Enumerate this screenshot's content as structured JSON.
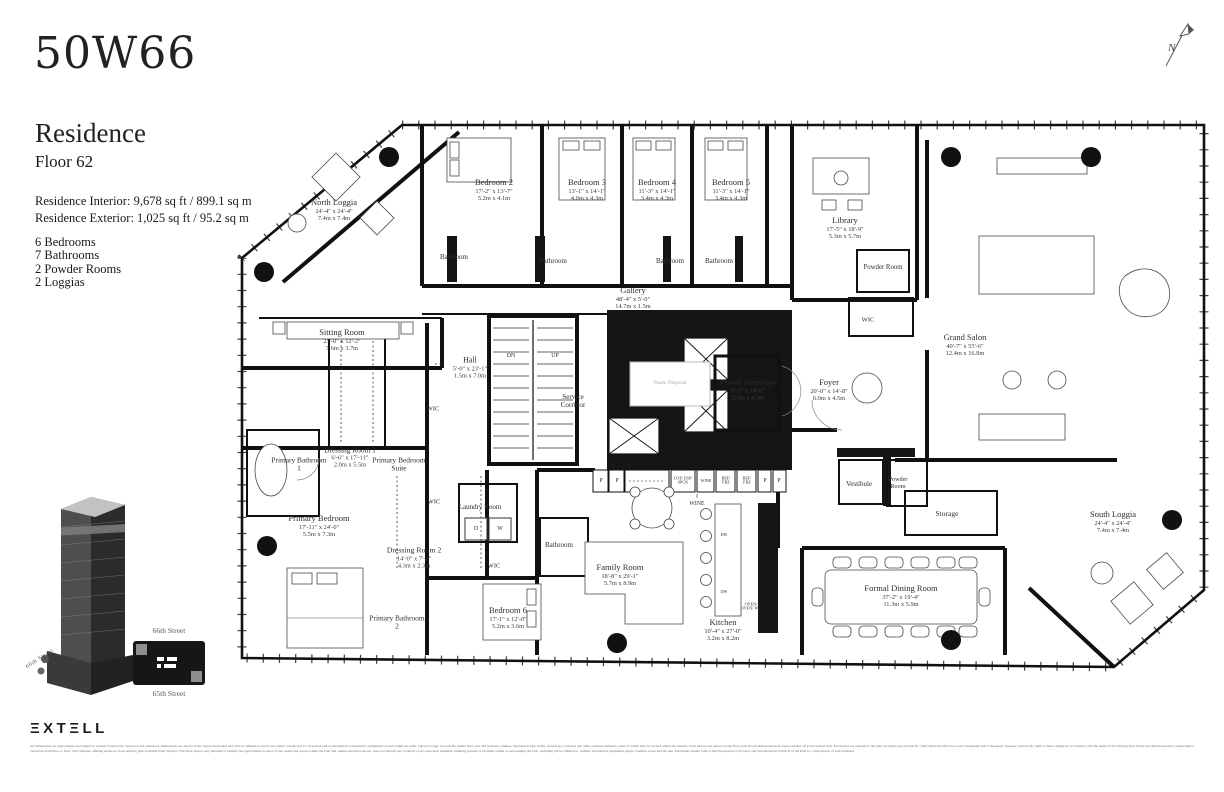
{
  "brand": {
    "logo": "50W66",
    "extell": "EXTELL",
    "extell_display": "ΞXTΞLL"
  },
  "header": {
    "title": "Residence",
    "floor": "Floor 62",
    "interior": "Residence Interior: 9,678 sq ft / 899.1 sq m",
    "exterior": "Residence Exterior: 1,025 sq ft / 95.2 sq m",
    "features": [
      "6 Bedrooms",
      "7 Bathrooms",
      "2 Powder Rooms",
      "2 Loggias"
    ]
  },
  "compass": {
    "label": "N"
  },
  "site": {
    "street_top": "66th Street",
    "street_bottom": "65th Street",
    "tower_street": "66th Street"
  },
  "plan": {
    "rooms": [
      {
        "n": "North Loggia",
        "f": "24'-4\" x 24'-4\"",
        "m": "7.4m x 7.4m",
        "x": 97,
        "y": 92
      },
      {
        "n": "Bedroom 2",
        "f": "17'-2\" x 13'-7\"",
        "m": "5.2m x 4.1m",
        "x": 257,
        "y": 72
      },
      {
        "n": "Bedroom 3",
        "f": "13'-1\" x 14'-1\"",
        "m": "4.0m x 4.3m",
        "x": 350,
        "y": 72
      },
      {
        "n": "Bedroom 4",
        "f": "11'-3\" x 14'-1\"",
        "m": "3.4m x 4.3m",
        "x": 420,
        "y": 72
      },
      {
        "n": "Bedroom 5",
        "f": "11'-3\" x 14'-1\"",
        "m": "3.4m x 4.3m",
        "x": 494,
        "y": 72
      },
      {
        "n": "Library",
        "f": "17'-5\" x 18'-9\"",
        "m": "5.3m x 5.7m",
        "x": 608,
        "y": 110
      },
      {
        "n": "Powder Room",
        "x": 646,
        "y": 150,
        "fs": 6.8,
        "w": 40
      },
      {
        "n": "Bathroom",
        "x": 217,
        "y": 140,
        "fs": 7
      },
      {
        "n": "Bathroom",
        "x": 316,
        "y": 144,
        "fs": 7
      },
      {
        "n": "Bathroom",
        "x": 433,
        "y": 144,
        "fs": 7
      },
      {
        "n": "Bathroom",
        "x": 482,
        "y": 144,
        "fs": 7
      },
      {
        "n": "Gallery",
        "f": "48'-4\" x 5'-0\"",
        "m": "14.7m x 1.5m",
        "x": 396,
        "y": 180
      },
      {
        "n": "Hall",
        "f": "5'-0\" x 23'-1\"",
        "m": "1.5m x 7.0m",
        "x": 233,
        "y": 250,
        "fs": 8
      },
      {
        "n": "Service Corridor",
        "x": 336,
        "y": 283,
        "fs": 7.2,
        "w": 46
      },
      {
        "n": "WIC",
        "x": 631,
        "y": 202,
        "fs": 6.5
      },
      {
        "n": "Grand Salon",
        "f": "40'-7\" x 55'-6\"",
        "m": "12.4m x 16.9m",
        "x": 728,
        "y": 227
      },
      {
        "n": "Sitting Room",
        "f": "25'-0\" x 12'-2\"",
        "m": "7.6m x 3.7m",
        "x": 105,
        "y": 222
      },
      {
        "n": "Private Reception",
        "f": "8'-1\" x 14'-0\"",
        "m": "2.5m x 4.3m",
        "x": 511,
        "y": 272,
        "fs": 7.8,
        "w": 62
      },
      {
        "n": "Foyer",
        "f": "20'-0\" x 14'-8\"",
        "m": "6.0m x 4.5m",
        "x": 592,
        "y": 272
      },
      {
        "n": "Primary Bathroom 1",
        "x": 62,
        "y": 347,
        "fs": 7.4,
        "w": 58
      },
      {
        "n": "Dressing Room 1",
        "f": "6'-6\" x 17'-11\"",
        "m": "2.0m x 5.5m",
        "x": 113,
        "y": 340,
        "fs": 7.4,
        "w": 72
      },
      {
        "n": "Primary Bedroom Suite",
        "x": 162,
        "y": 347,
        "fs": 7.4,
        "w": 56
      },
      {
        "n": "WIC",
        "x": 196,
        "y": 291,
        "fs": 6.5
      },
      {
        "n": "Vestibule",
        "x": 622,
        "y": 367,
        "fs": 7
      },
      {
        "n": "Powder Room",
        "x": 661,
        "y": 366,
        "fs": 6.2,
        "w": 34
      },
      {
        "n": "Storage",
        "x": 710,
        "y": 396,
        "fs": 7.5
      },
      {
        "n": "Primary Bedroom",
        "f": "17'-11\" x 24'-0\"",
        "m": "5.5m x 7.3m",
        "x": 82,
        "y": 408
      },
      {
        "n": "Dressing Room 2",
        "f": "14'-0\" x 7'-6\"",
        "m": "4.3m x 2.3m",
        "x": 177,
        "y": 440,
        "fs": 7.8,
        "w": 76
      },
      {
        "n": "WIC",
        "x": 197,
        "y": 384,
        "fs": 6.5
      },
      {
        "n": "Laundry Room",
        "x": 243,
        "y": 390,
        "fs": 7,
        "w": 44
      },
      {
        "n": "WIC",
        "x": 257,
        "y": 448,
        "fs": 6.5
      },
      {
        "n": "Bathroom",
        "x": 322,
        "y": 428,
        "fs": 7
      },
      {
        "n": "Family Room",
        "f": "18'-8\" x 29'-1\"",
        "m": "5.7m x 8.9m",
        "x": 383,
        "y": 457
      },
      {
        "n": "Kitchen",
        "f": "10'-4\" x 27'-0\"",
        "m": "3.2m x 8.2m",
        "x": 486,
        "y": 512
      },
      {
        "n": "Formal Dining Room",
        "f": "37'-2\" x 19'-4\"",
        "m": "11.3m x 5.9m",
        "x": 664,
        "y": 478
      },
      {
        "n": "South Loggia",
        "f": "24'-4\" x 24'-4\"",
        "m": "7.4m x 7.4m",
        "x": 876,
        "y": 404
      },
      {
        "n": "Primary Bathroom 2",
        "x": 160,
        "y": 505,
        "fs": 7.4,
        "w": 58
      },
      {
        "n": "Bedroom 6",
        "f": "17'-1\" x 12'-0\"",
        "m": "5.2m x 3.6m",
        "x": 271,
        "y": 500
      }
    ],
    "small_labels": [
      {
        "t": "DN",
        "x": 274,
        "y": 238
      },
      {
        "t": "UP",
        "x": 318,
        "y": 238
      },
      {
        "t": "Waste Disposal",
        "x": 433,
        "y": 266,
        "c": "ghost"
      },
      {
        "t": "P",
        "x": 364,
        "y": 363
      },
      {
        "t": "P",
        "x": 380,
        "y": 363
      },
      {
        "t": "COF/ ESP/ SPCK",
        "x": 446,
        "y": 363,
        "c": "xs",
        "w": 20
      },
      {
        "t": "WINE",
        "x": 469,
        "y": 363,
        "c": "xs"
      },
      {
        "t": "REF/ FRZ",
        "x": 489,
        "y": 363,
        "c": "xs",
        "w": 16
      },
      {
        "t": "REF/ FRZ",
        "x": 510,
        "y": 363,
        "c": "xs",
        "w": 16
      },
      {
        "t": "P",
        "x": 528,
        "y": 363
      },
      {
        "t": "P",
        "x": 542,
        "y": 363
      },
      {
        "t": "WINE",
        "x": 460,
        "y": 386
      },
      {
        "t": "DW",
        "x": 487,
        "y": 417,
        "c": "xs"
      },
      {
        "t": "DW",
        "x": 487,
        "y": 474,
        "c": "xs"
      },
      {
        "t": "OVEN/ OVEN/ WD",
        "x": 514,
        "y": 489,
        "c": "xs",
        "w": 24
      },
      {
        "t": "D",
        "x": 239,
        "y": 411
      },
      {
        "t": "W",
        "x": 263,
        "y": 411
      }
    ]
  },
  "footer": {
    "disclaimer": "All dimensions are approximate and subject to normal construction variances and tolerances. Dimensions are shown as the largest horizontal and vertical dimension and do not reflect a deduction for structural and/or mechanical components; equipment located within the units. Square footage exceeds the usable floor area and includes columns, mechanical pipe shafts, chaseways, corridors and other common elements, some of which may be located within the exterior walls and are not shown on the floor plan. Room dimensions have been rounded off to the nearest inch. Purchasers are referred to the plan, including special risk No. (38) which describes how each residential unit is measured. Sponsor reserves the right to make changes in accordance with the terms of the offering plan. Plans and dimensions may contain minor variations from floor to floor. The complete offering terms are in an offering plan available from Sponsor. This floor plan is only intended to identify the approximate location of the rooms and spaces within the Unit and, unless otherwise shown, does not identify the locations of any structural elements, building systems or facilities within or surrounding the Unit, including but not limited to, utilities, mechanical equipment, pipes, conduits, risers and the like. Purchasers should refer to the Description of Property and Specifications in Part II of the Plan for a description of such facilities."
  }
}
